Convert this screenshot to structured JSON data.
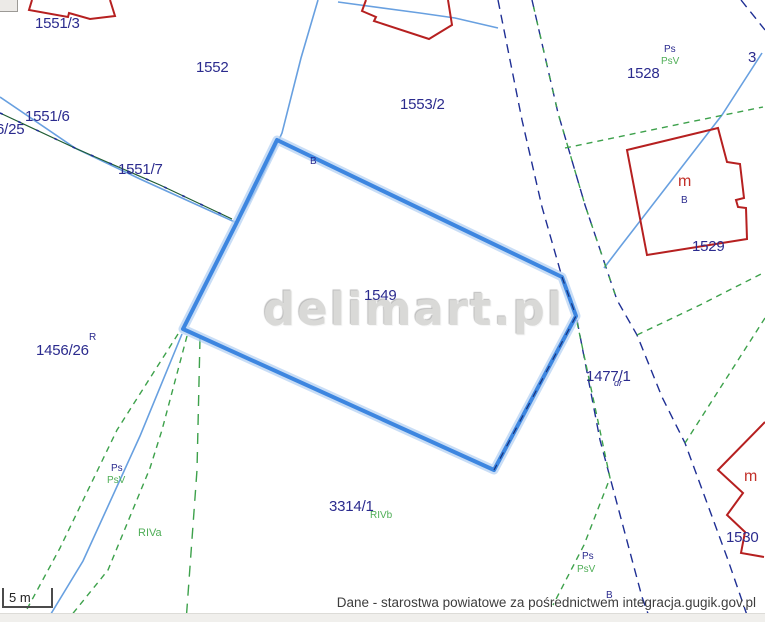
{
  "map": {
    "watermark": "delimart.pl",
    "selected_parcel": "1549",
    "scale": {
      "label": "5 m"
    },
    "attribution": "Dane - starostwa powiatowe za pośrednictwem integracja.gugik.gov.pl",
    "colors": {
      "selected_parcel_outline": "#3d86e0",
      "selected_parcel_halo": "#b5d2f3",
      "cadastral_boundary": "#1f2f94",
      "parcel_line_light": "#68a0e0",
      "landuse_line": "#3da14b",
      "landuse_dark_line": "#1e5c33",
      "building_outline": "#b62020",
      "parcel_label": "#2b2b8e",
      "soil_label": "#4fae57",
      "building_label": "#c2302a"
    },
    "labels": [
      {
        "text": "1551/3",
        "kind": "parcel",
        "x": 35,
        "y": 16
      },
      {
        "text": "1552",
        "kind": "parcel",
        "x": 196,
        "y": 60
      },
      {
        "text": "1553/2",
        "kind": "parcel",
        "x": 400,
        "y": 97
      },
      {
        "text": "1528",
        "kind": "parcel",
        "x": 627,
        "y": 66
      },
      {
        "text": "3",
        "kind": "parcel",
        "x": 748,
        "y": 50
      },
      {
        "text": "1551/6",
        "kind": "parcel",
        "x": 25,
        "y": 109
      },
      {
        "text": "6/25",
        "kind": "parcel",
        "x": -4,
        "y": 122
      },
      {
        "text": "1551/7",
        "kind": "parcel",
        "x": 118,
        "y": 162
      },
      {
        "text": "1529",
        "kind": "parcel",
        "x": 692,
        "y": 239
      },
      {
        "text": "1549",
        "kind": "parcel",
        "x": 364,
        "y": 288
      },
      {
        "text": "1456/26",
        "kind": "parcel",
        "x": 36,
        "y": 343
      },
      {
        "text": "1477/1",
        "kind": "parcel",
        "x": 586,
        "y": 369
      },
      {
        "text": "3314/1",
        "kind": "parcel",
        "x": 329,
        "y": 499
      },
      {
        "text": "1530",
        "kind": "parcel",
        "x": 726,
        "y": 530
      },
      {
        "text": "R",
        "kind": "small",
        "x": 89,
        "y": 333
      },
      {
        "text": "B",
        "kind": "small",
        "x": 310,
        "y": 157
      },
      {
        "text": "B",
        "kind": "small",
        "x": 681,
        "y": 196
      },
      {
        "text": "B",
        "kind": "small",
        "x": 606,
        "y": 591
      },
      {
        "text": "dr",
        "kind": "smalli",
        "x": 614,
        "y": 379
      },
      {
        "text": "Ps",
        "kind": "small",
        "x": 664,
        "y": 45
      },
      {
        "text": "PsV",
        "kind": "green",
        "x": 661,
        "y": 57
      },
      {
        "text": "Ps",
        "kind": "small",
        "x": 111,
        "y": 464
      },
      {
        "text": "PsV",
        "kind": "green",
        "x": 107,
        "y": 476
      },
      {
        "text": "Ps",
        "kind": "small",
        "x": 582,
        "y": 552
      },
      {
        "text": "PsV",
        "kind": "green",
        "x": 577,
        "y": 565
      },
      {
        "text": "RIVa",
        "kind": "greenlg",
        "x": 138,
        "y": 528
      },
      {
        "text": "RIVb",
        "kind": "green",
        "x": 370,
        "y": 511
      },
      {
        "text": "m",
        "kind": "red",
        "x": 678,
        "y": 174
      },
      {
        "text": "m",
        "kind": "red",
        "x": 744,
        "y": 469
      }
    ]
  }
}
